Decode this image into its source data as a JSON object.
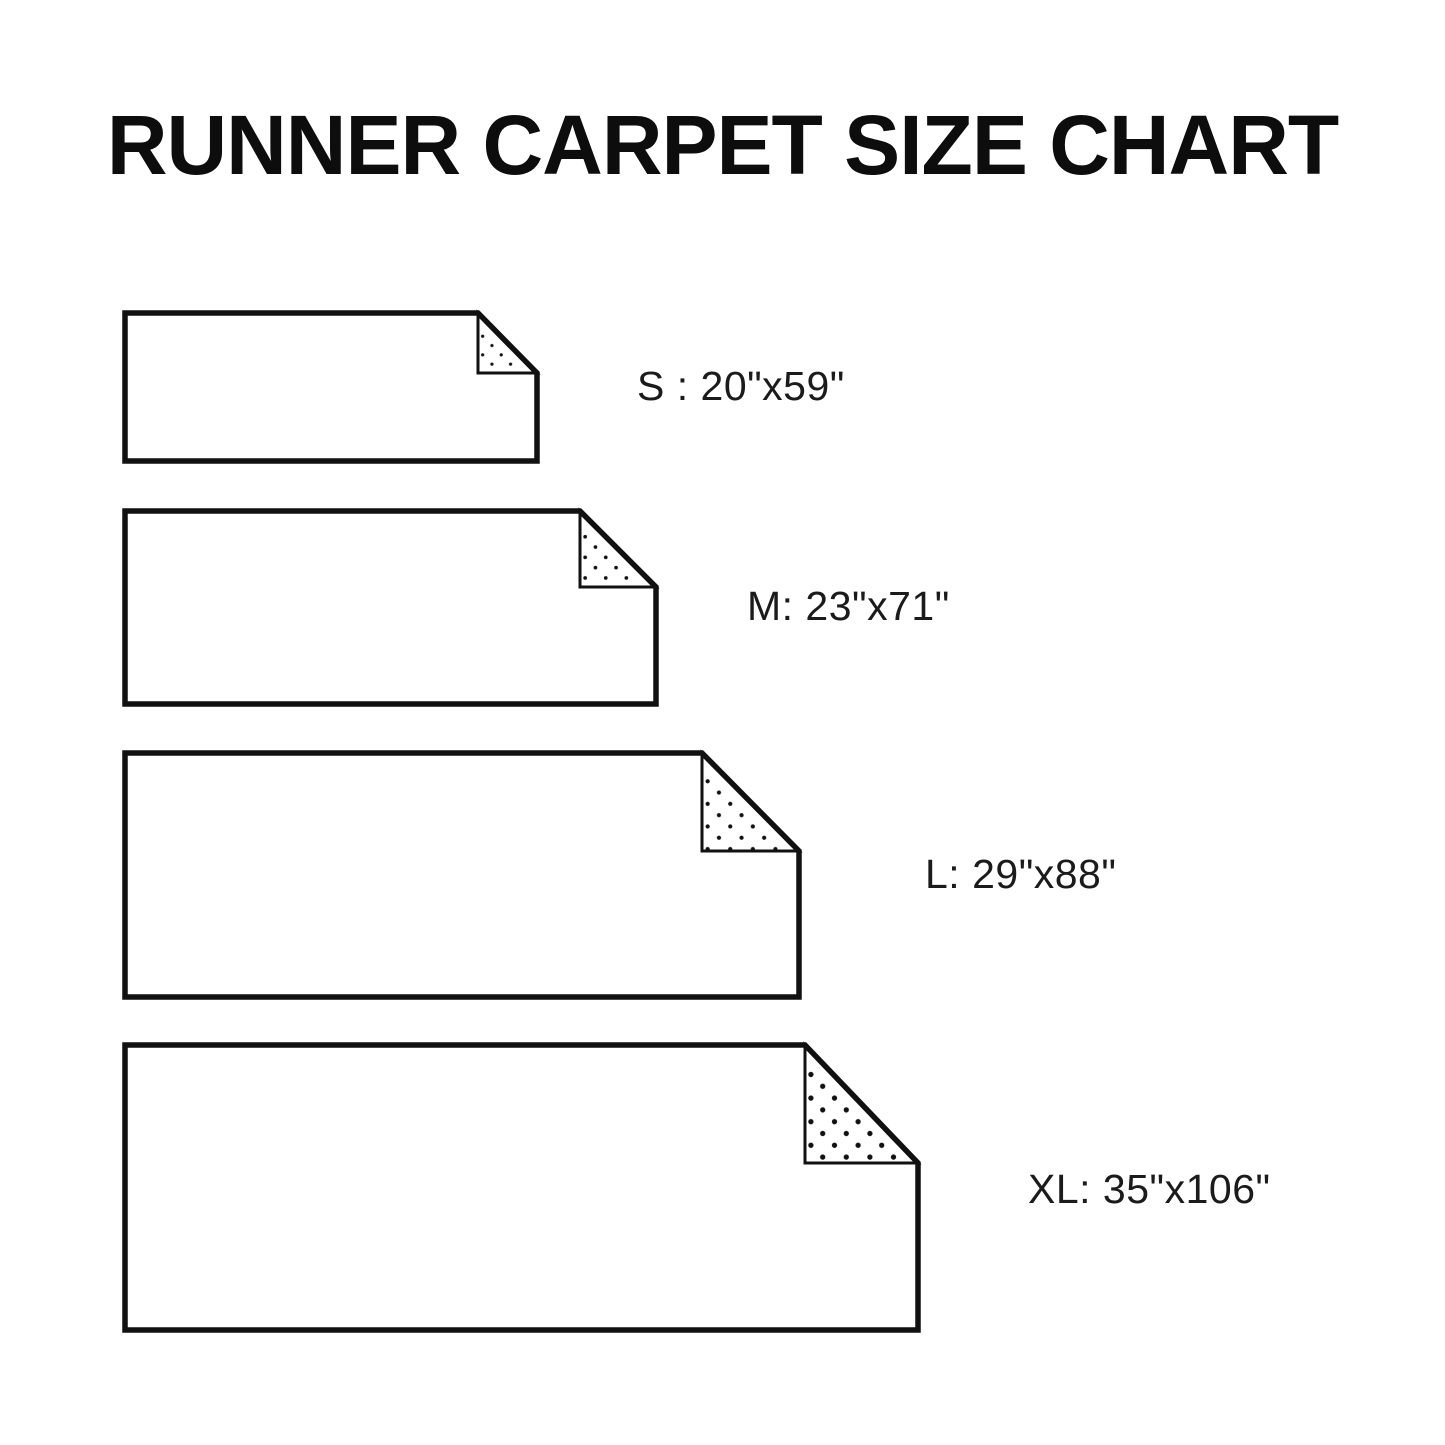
{
  "title": "RUNNER CARPET SIZE CHART",
  "sizes": [
    {
      "size": "S",
      "width_in": 20,
      "length_in": 59,
      "dimensions": "20\"x59\"",
      "label": "S : 20\"x59\""
    },
    {
      "size": "M",
      "width_in": 23,
      "length_in": 71,
      "dimensions": "23\"x71\"",
      "label": "M: 23\"x71\""
    },
    {
      "size": "L",
      "width_in": 29,
      "length_in": 88,
      "dimensions": "29\"x88\"",
      "label": "L: 29\"x88\""
    },
    {
      "size": "XL",
      "width_in": 35,
      "length_in": 106,
      "dimensions": "35\"x106\"",
      "label": "XL: 35\"x106\""
    }
  ],
  "colors": {
    "ink": "#111111",
    "background": "#ffffff"
  }
}
